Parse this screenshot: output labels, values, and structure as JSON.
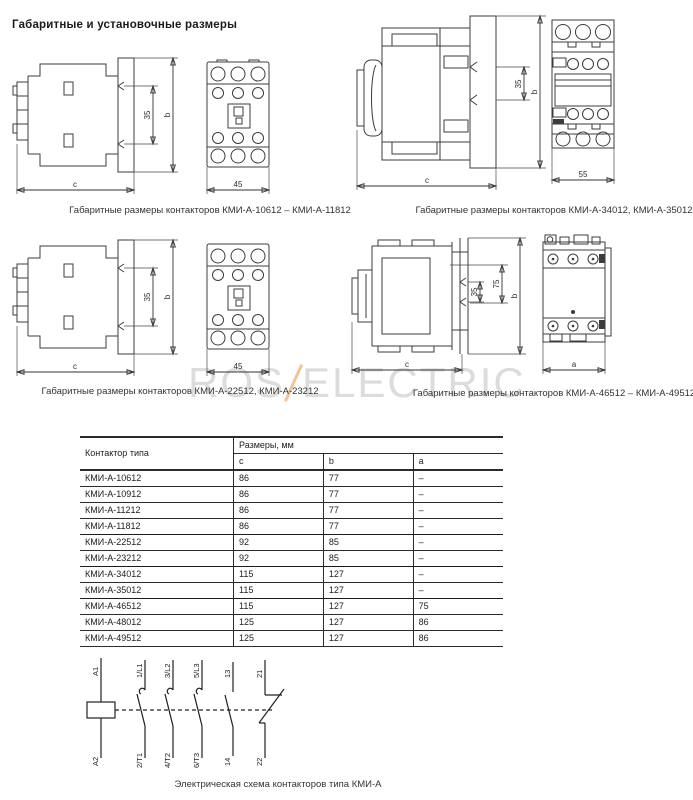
{
  "page": {
    "title": "Габаритные и установочные размеры"
  },
  "watermark": {
    "left": "ROS",
    "right": "ELECTRIC",
    "slash_color": "#f2c498",
    "text_color": "#dcdcdc"
  },
  "drawings": [
    {
      "caption": "Габаритные размеры контакторов КМИ-А-10612 – КМИ-А-11812",
      "dims": {
        "rail": "35",
        "height": "b",
        "width": "c",
        "front": "45"
      }
    },
    {
      "caption": "Габаритные размеры контакторов КМИ-А-34012, КМИ-А-35012",
      "dims": {
        "rail": "35",
        "height": "b",
        "width": "c",
        "front": "55"
      }
    },
    {
      "caption": "Габаритные размеры контакторов КМИ-А-22512, КМИ-А-23212",
      "dims": {
        "rail": "35",
        "height": "b",
        "width": "c",
        "front": "45"
      }
    },
    {
      "caption": "Габаритные размеры контакторов КМИ-А-46512 – КМИ-А-49512",
      "dims": {
        "rail": "35",
        "inner": "75",
        "height": "b",
        "width": "c",
        "front": "a"
      }
    }
  ],
  "table": {
    "header": {
      "type_col": "Контактор типа",
      "dims_col": "Размеры, мм",
      "sub": [
        "c",
        "b",
        "a"
      ]
    },
    "rows": [
      {
        "model": "КМИ-А-10612",
        "c": "86",
        "b": "77",
        "a": "–"
      },
      {
        "model": "КМИ-А-10912",
        "c": "86",
        "b": "77",
        "a": "–"
      },
      {
        "model": "КМИ-А-11212",
        "c": "86",
        "b": "77",
        "a": "–"
      },
      {
        "model": "КМИ-А-11812",
        "c": "86",
        "b": "77",
        "a": "–"
      },
      {
        "model": "КМИ-А-22512",
        "c": "92",
        "b": "85",
        "a": "–"
      },
      {
        "model": "КМИ-А-23212",
        "c": "92",
        "b": "85",
        "a": "–"
      },
      {
        "model": "КМИ-А-34012",
        "c": "115",
        "b": "127",
        "a": "–"
      },
      {
        "model": "КМИ-А-35012",
        "c": "115",
        "b": "127",
        "a": "–"
      },
      {
        "model": "КМИ-А-46512",
        "c": "115",
        "b": "127",
        "a": "75"
      },
      {
        "model": "КМИ-А-48012",
        "c": "125",
        "b": "127",
        "a": "86"
      },
      {
        "model": "КМИ-А-49512",
        "c": "125",
        "b": "127",
        "a": "86"
      }
    ]
  },
  "schematic": {
    "caption": "Электрическая схема контакторов типа КМИ-А",
    "labels": {
      "a1": "A1",
      "a2": "A2",
      "l1": "1/L1",
      "t1": "2/T1",
      "l2": "3/L2",
      "t2": "4/T2",
      "l3": "5/L3",
      "t3": "6/T3",
      "no13": "13",
      "no14": "14",
      "nc21": "21",
      "nc22": "22"
    }
  }
}
